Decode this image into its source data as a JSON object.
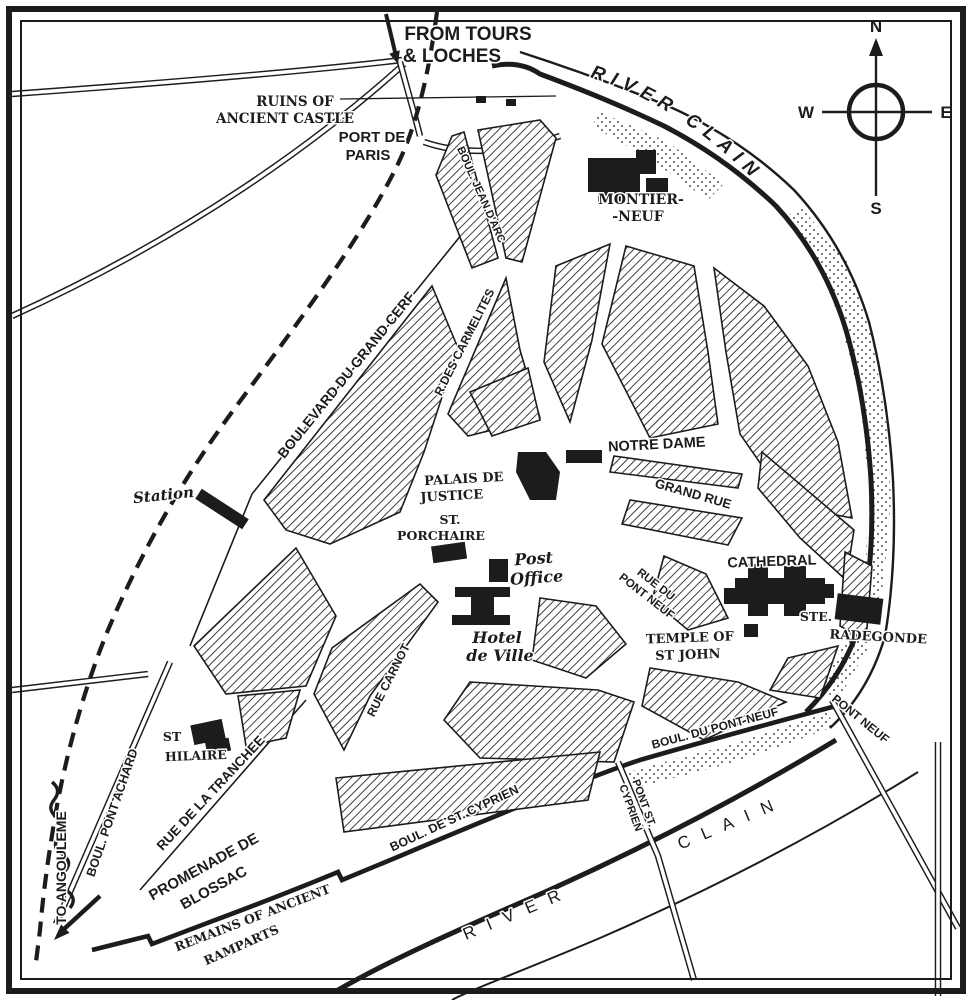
{
  "colors": {
    "ink": "#1c1c1c",
    "paper": "#ffffff"
  },
  "compass": {
    "north": "N",
    "south": "S",
    "east": "E",
    "west": "W"
  },
  "rivers": {
    "top": "RIVER CLAIN",
    "bottom_word1": "RIVER",
    "bottom_word2": "CLAIN"
  },
  "routes": {
    "from_tours_l1": "FROM TOURS",
    "from_tours_l2": "& LOCHES",
    "to_angouleme": "TO ANGOULEME"
  },
  "streets": {
    "boul_jean_darc": "BOUL. JEAN D'ARC",
    "boulevard_du_grand_cerf": "BOULEVARD DU GRAND CERF",
    "r_des_carmelites": "R.DES CARMELITES",
    "grand_rue": "GRAND RUE",
    "rue_du_pont_neuf_l1": "RUE DU",
    "rue_du_pont_neuf_l2": "PONT NEUF",
    "rue_carnot": "RUE CARNOT",
    "rue_de_la_tranchee": "RUE DE LA TRANCHEE",
    "boul_pont_achard": "BOUL. PONT ACHARD",
    "boul_du_pont_neuf": "BOUL. DU PONT NEUF",
    "boul_de_st_cyprien": "BOUL. DE ST. CYPRIEN"
  },
  "bridges": {
    "pont_neuf": "PONT NEUF",
    "pont_st_cyprien_l1": "PONT ST.",
    "pont_st_cyprien_l2": "CYPRIEN"
  },
  "places": {
    "ruins_l1": "RUINS OF",
    "ruins_l2": "ANCIENT CASTLE",
    "port_de_paris_l1": "PORT DE",
    "port_de_paris_l2": "PARIS",
    "montierneuf_l1": "MONTIER-",
    "montierneuf_l2": "-NEUF",
    "notre_dame": "NOTRE DAME",
    "palais_l1": "PALAIS DE",
    "palais_l2": "JUSTICE",
    "st_porchaire_l1": "ST.",
    "st_porchaire_l2": "PORCHAIRE",
    "post_office_l1": "Post",
    "post_office_l2": "Office",
    "hotel_de_ville_l1": "Hotel",
    "hotel_de_ville_l2": "de Ville",
    "cathedral": "CATHEDRAL",
    "temple_l1": "TEMPLE OF",
    "temple_l2": "ST JOHN",
    "ste_radegonde_l1": "STE.",
    "ste_radegonde_l2": "RADEGONDE",
    "station": "Station",
    "st_hilaire_l1": "ST",
    "st_hilaire_l2": "HILAIRE",
    "promenade_l1": "PROMENADE DE",
    "promenade_l2": "BLOSSAC",
    "remains_l1": "REMAINS OF ANCIENT",
    "remains_l2": "RAMPARTS"
  }
}
